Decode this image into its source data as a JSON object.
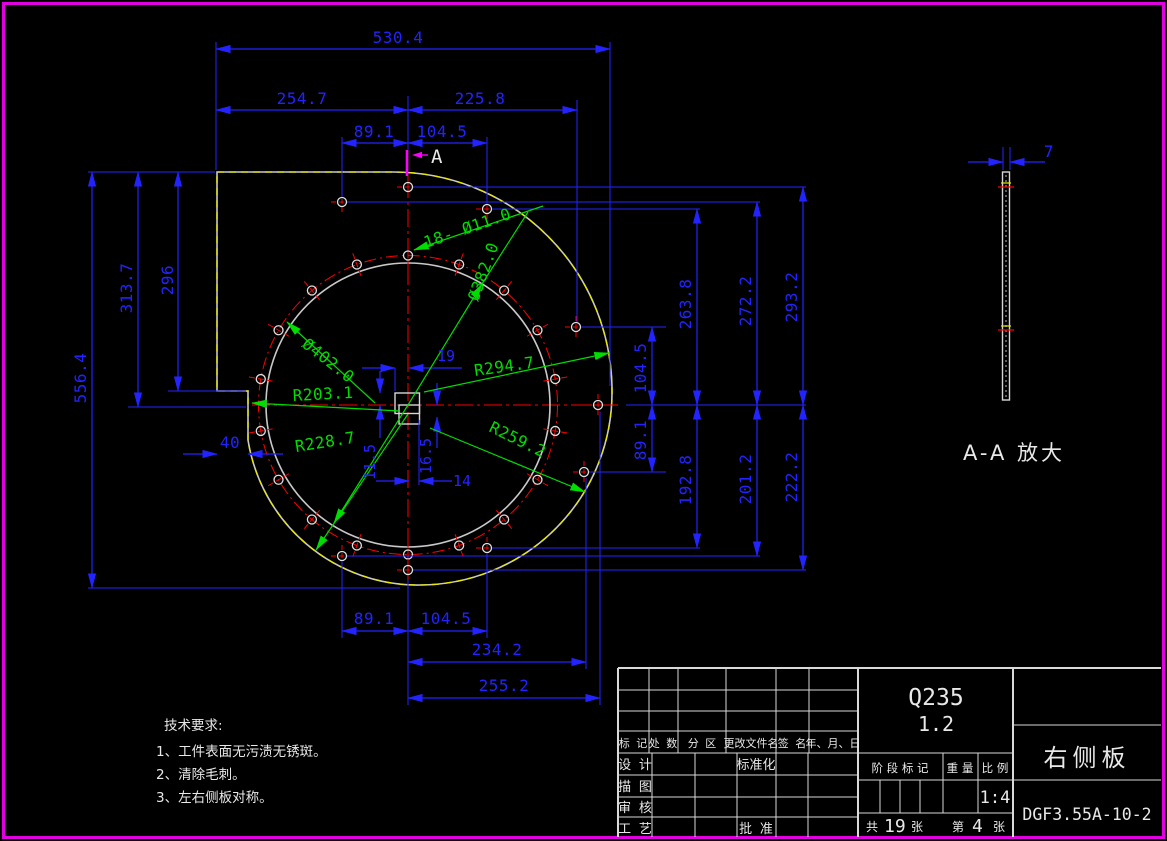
{
  "frame": {
    "color": "#ff00ff"
  },
  "colors": {
    "dim": "#2323ff",
    "center": "#ff0000",
    "geometry": "#c9c9c9",
    "aux_dashed": "#e8e800",
    "radial_dim": "#00dd00",
    "section": "#ff00ff"
  },
  "view": {
    "section_label": "A",
    "labels": {
      "dim_530_4": "530.4",
      "dim_254_7": "254.7",
      "dim_225_8": "225.8",
      "dim_89_1_top": "89.1",
      "dim_104_5_top": "104.5",
      "dim_556_4": "556.4",
      "dim_313_7": "313.7",
      "dim_296": "296",
      "dim_40": "40",
      "dim_104_5_right": "104.5",
      "dim_89_1_right": "89.1",
      "dim_263_8": "263.8",
      "dim_192_8": "192.8",
      "dim_272_2": "272.2",
      "dim_201_2": "201.2",
      "dim_293_2": "293.2",
      "dim_222_2": "222.2",
      "dim_89_1_bottom": "89.1",
      "dim_104_5_bottom": "104.5",
      "dim_234_2": "234.2",
      "dim_255_2": "255.2",
      "dim_19": "19",
      "dim_14": "14",
      "dim_16_5": "16.5",
      "dim_11_5": "11.5",
      "holes_note": "18- Ø11.0",
      "dia_382": "Ø382.0",
      "dia_402": "Ø402.0",
      "r_203_1": "R203.1",
      "r_228_7": "R228.7",
      "r_259_2": "R259.2",
      "r_294_7": "R294.7"
    }
  },
  "detail": {
    "thickness": "7",
    "title": "A-A 放大"
  },
  "tech": {
    "title": "技术要求:",
    "item1": "1、工件表面无污渍无锈斑。",
    "item2": "2、清除毛刺。",
    "item3": "3、左右侧板对称。"
  },
  "titleblock": {
    "rev": {
      "h1": "标 记",
      "h2": "处 数",
      "h3": "分 区",
      "h4": "更改文件名",
      "h5": "签 名",
      "h6": "年、月、日"
    },
    "rows": {
      "design": "设 计",
      "trace": "描 图",
      "check": "审 核",
      "process": "工 艺",
      "standard": "标准化",
      "approve": "批 准"
    },
    "material": "Q235",
    "thickness": "1.2",
    "stage": "阶 段 标 记",
    "weight": "重 量",
    "scale": "比 例",
    "scale_value": "1:4",
    "sheets": {
      "total_prefix": "共",
      "total": "19",
      "total_suffix": "张",
      "page_prefix": "第",
      "page": "4",
      "page_suffix": "张"
    },
    "part_name": "右侧板",
    "drawing_no": "DGF3.55A-10-2"
  }
}
